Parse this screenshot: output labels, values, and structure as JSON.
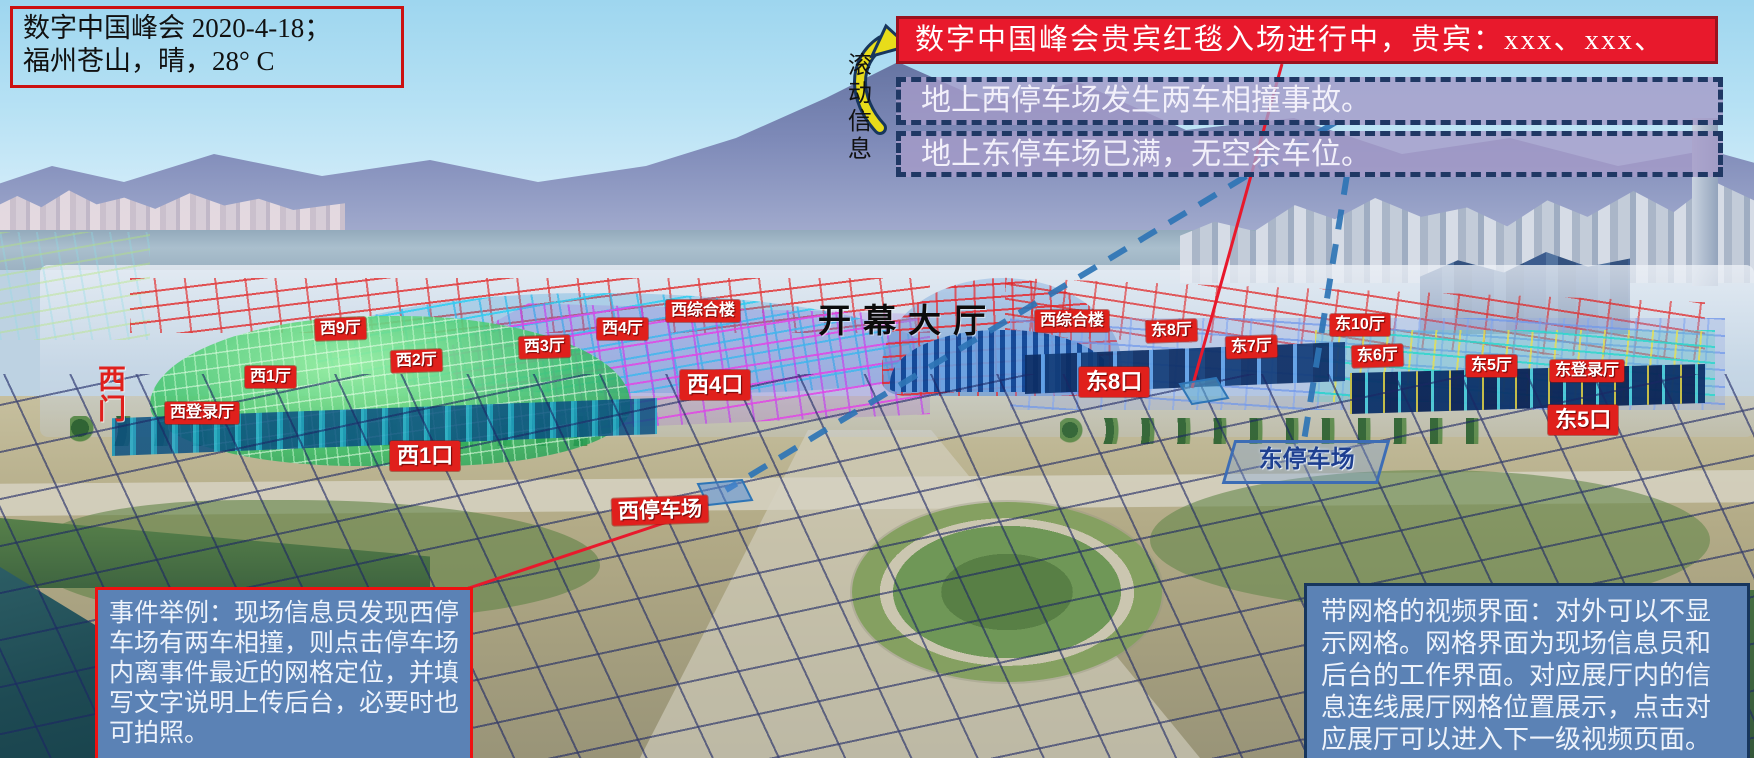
{
  "meta": {
    "line1": "数字中国峰会 2020-4-18；",
    "line2": "福州苍山，晴，28° C"
  },
  "ticker": {
    "scroll_label": "滚动信息",
    "vip_message": "数字中国峰会贵宾红毯入场进行中，贵宾：xxx、xxx、",
    "alert_west": "地上西停车场发生两车相撞事故。",
    "alert_east": "地上东停车场已满，无空余车位。"
  },
  "venue": {
    "main_hall": "开幕大厅",
    "west_gate": "西门",
    "halls": {
      "xi9": "西9厅",
      "xi2": "西2厅",
      "xi1": "西1厅",
      "xi3": "西3厅",
      "xi4": "西4厅",
      "xi_complex_west": "西综合楼",
      "xi_login": "西登录厅",
      "xi_complex_east": "西综合楼",
      "dong8": "东8厅",
      "dong7": "东7厅",
      "dong10": "东10厅",
      "dong6": "东6厅",
      "dong5": "东5厅",
      "dong_login": "东登录厅"
    },
    "gates": {
      "xi4": "西4口",
      "xi1": "西1口",
      "dong8": "东8口",
      "dong5": "东5口"
    },
    "parking": {
      "west": "西停车场",
      "east": "东停车场"
    }
  },
  "notes": {
    "event_example": "事件举例：现场信息员发现西停车场有两车相撞，则点击停车场内离事件最近的网格定位，并填写文字说明上传后台，必要时也可拍照。",
    "grid_interface": "带网格的视频界面：对外可以不显示网格。网格界面为现场信息员和后台的工作界面。对应展厅内的信息连线展厅网格位置展示，点击对应展厅可以进入下一级视频页面。"
  },
  "colors": {
    "banner_red": "#e8192c",
    "alert_purple": "#a89fc8",
    "note_blue": "#5b82b5",
    "label_red": "#e0201c",
    "dashed_navy": "#1f3864",
    "connector_blue": "#2e75b6",
    "arrow_yellow": "#e8dc1a"
  }
}
